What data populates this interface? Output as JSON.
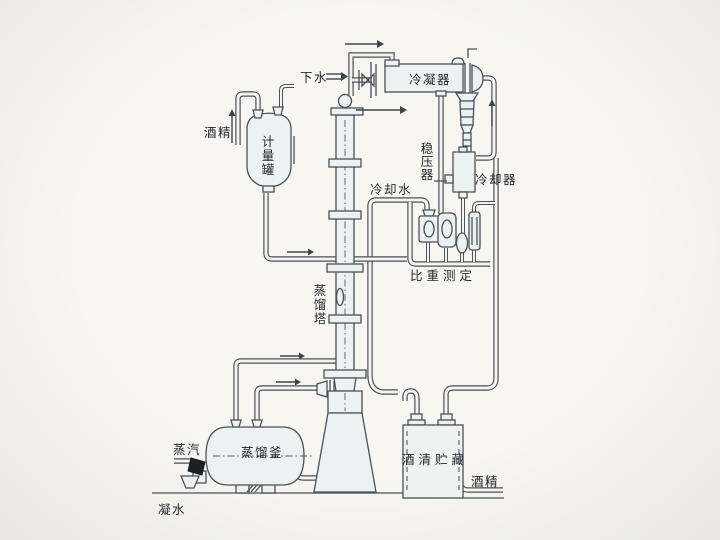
{
  "diagram_labels": {
    "down_water": "下水",
    "condenser": "冷凝器",
    "alcohol_in": "酒精",
    "measuring_tank": [
      "计",
      "量",
      "罐"
    ],
    "stabilizer": [
      "稳",
      "压",
      "器"
    ],
    "cooling_water": "冷却水",
    "cooler": "冷却器",
    "gravity_measure": "比重测定",
    "tower": [
      "蒸",
      "馏",
      "塔"
    ],
    "kettle": "蒸馏釜",
    "steam": "蒸汽",
    "storage": "酒清贮藏",
    "alcohol_out": "酒精",
    "condensate": "凝水"
  },
  "colors": {
    "line": "#4b5156",
    "vessel_fill": "#edf1f2",
    "paper": "#f5f4f0",
    "arrow": "#3f444a"
  }
}
